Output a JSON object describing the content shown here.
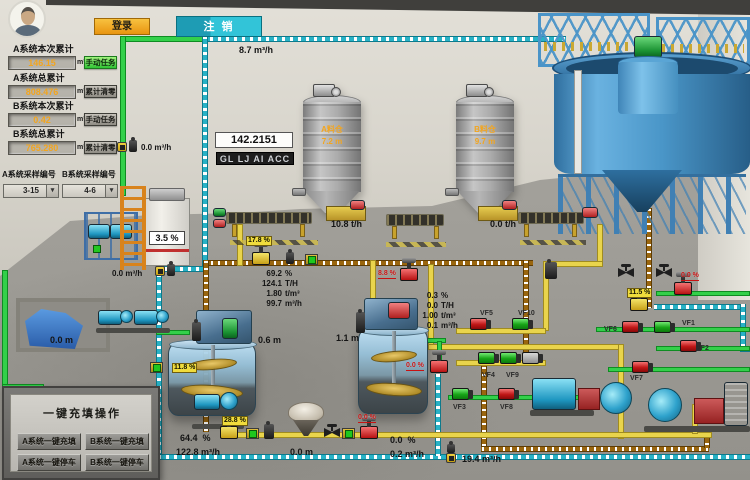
{
  "topbar": {
    "login": "登录",
    "logout": "注 销"
  },
  "totals": [
    {
      "label": "A系统本次累计",
      "value": "146.15",
      "unit": "m³",
      "action": "手动任务"
    },
    {
      "label": "A系统总累计",
      "value": "808.476",
      "unit": "m³",
      "action": "累计清零"
    },
    {
      "label": "B系统本次累计",
      "value": "0.42",
      "unit": "m³",
      "action": "手动任务"
    },
    {
      "label": "B系统总累计",
      "value": "765.280",
      "unit": "m³",
      "action": "累计清零"
    }
  ],
  "samplers": [
    {
      "label": "A系统采样编号",
      "value": "3-15"
    },
    {
      "label": "B系统采样编号",
      "value": "4-6"
    }
  ],
  "display_box": {
    "value": "142.2151",
    "tag": "GL LJ AI ACC"
  },
  "flows": {
    "top": {
      "value": "8.7",
      "unit": "m³/h"
    },
    "left_upper": {
      "value": "0.0",
      "unit": "m³/h"
    },
    "left_lower": {
      "value": "0.0",
      "unit": "m³/h"
    },
    "bottom": {
      "value": "19.4",
      "unit": "m³/h"
    }
  },
  "silo_a": {
    "name": "A料仓",
    "level": "7.2",
    "unit": "m",
    "feed": "10.8",
    "feed_unit": "t/h"
  },
  "silo_b": {
    "name": "B料仓",
    "level": "9.7",
    "unit": "m",
    "feed": "0.0",
    "feed_unit": "t/h"
  },
  "left_tank": {
    "value": "3.5",
    "unit": "%"
  },
  "pool": {
    "value": "0.0",
    "unit": "m"
  },
  "mixer_a": {
    "level": "0.6",
    "unit": "m"
  },
  "mixer_b": {
    "level": "1.1",
    "unit": "m"
  },
  "readings_a": [
    {
      "v": "69.2",
      "u": "%"
    },
    {
      "v": "124.1",
      "u": "T/H"
    },
    {
      "v": "1.80",
      "u": "t/m³"
    },
    {
      "v": "99.7",
      "u": "m³/h"
    }
  ],
  "readings_b": [
    {
      "v": "0.3",
      "u": "%"
    },
    {
      "v": "0.0",
      "u": "T/H"
    },
    {
      "v": "1.00",
      "u": "t/m³"
    },
    {
      "v": "0.1",
      "u": "m³/h"
    }
  ],
  "bottom_a": [
    {
      "v": "64.4",
      "u": "%"
    },
    {
      "v": "122.8",
      "u": "m³/h"
    }
  ],
  "bottom_mid": {
    "value": "0.0",
    "unit": "m"
  },
  "bottom_b": [
    {
      "v": "0.0",
      "u": "%"
    },
    {
      "v": "0.2",
      "u": "m³/h"
    }
  ],
  "valves": [
    "VF1",
    "VF2",
    "VF3",
    "VF4",
    "VF5",
    "VF6",
    "VF7",
    "VF8",
    "VF9",
    "VF10"
  ],
  "pct": {
    "feeder": "17.8 %",
    "mixer_b_feed": "8.8 %",
    "underflow": "11.5 %",
    "thickener_out": "0.0 %",
    "mixer_a_in": "11.8 %",
    "fill_valve": "28.8 %",
    "mixer_b_out": "0.0 %",
    "bottom_valve": "0.0 %"
  },
  "panel": {
    "title": "一键充填操作",
    "buttons": [
      "A系统一键充填",
      "B系统一键充填",
      "A系统一键停车",
      "B系统一键停车"
    ]
  }
}
